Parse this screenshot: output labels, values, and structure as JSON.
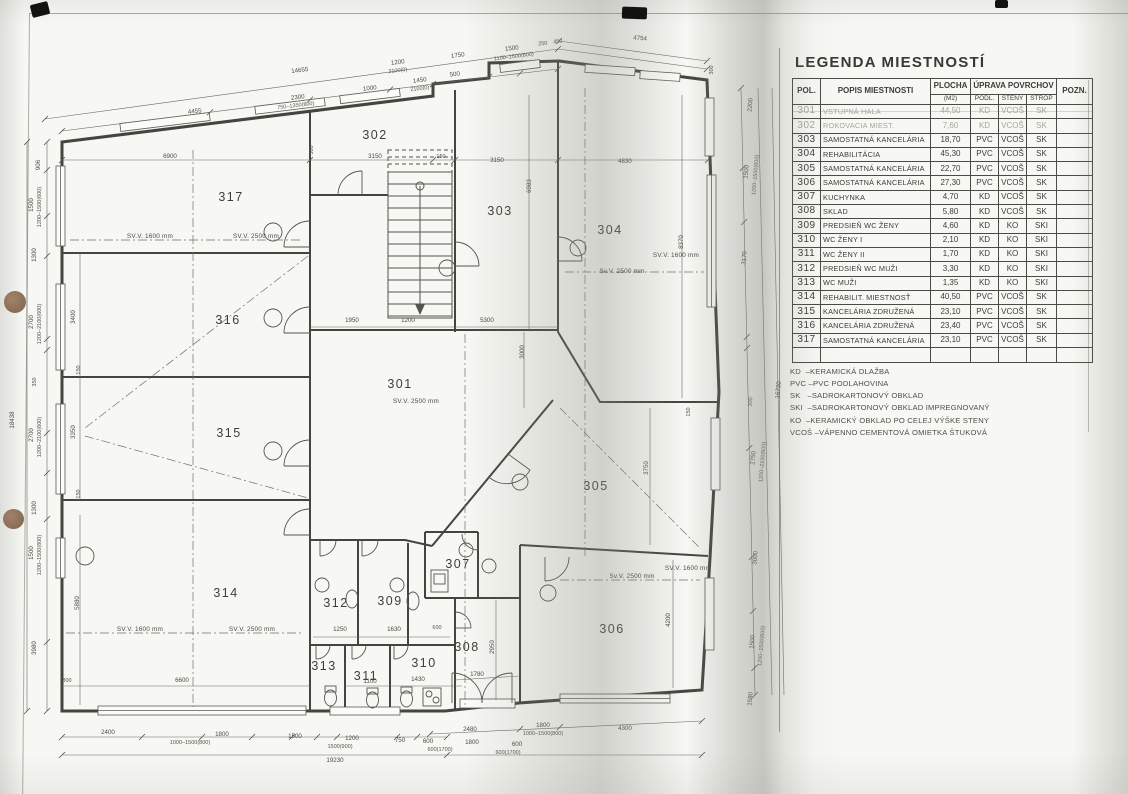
{
  "legend": {
    "title": "LEGENDA MIESTNOSTÍ",
    "header": {
      "pol": "POL.",
      "popis": "POPIS MIESTNOSTI",
      "plocha": "PLOCHA",
      "plocha_unit": "(M2)",
      "uprava": "ÚPRAVA POVRCHOV",
      "podl": "PODL.",
      "steny": "STENY",
      "strop": "STROP",
      "pozn": "POZN."
    },
    "rows": [
      {
        "pol": "301",
        "popis": "VSTUPNÁ HALA",
        "plocha": "44,50",
        "podl": "KD",
        "steny": "VCOŠ",
        "strop": "SK",
        "pozn": "",
        "faded": true
      },
      {
        "pol": "302",
        "popis": "ROKOVACIA MIEST.",
        "plocha": "7,60",
        "podl": "KD",
        "steny": "VCOŠ",
        "strop": "SK",
        "pozn": "",
        "faded": true
      },
      {
        "pol": "303",
        "popis": "SAMOSTATNÁ KANCELÁRIA",
        "plocha": "18,70",
        "podl": "PVC",
        "steny": "VCOŠ",
        "strop": "SK",
        "pozn": ""
      },
      {
        "pol": "304",
        "popis": "REHABILITÁCIA",
        "plocha": "45,30",
        "podl": "PVC",
        "steny": "VCOŠ",
        "strop": "SK",
        "pozn": ""
      },
      {
        "pol": "305",
        "popis": "SAMOSTATNÁ KANCELÁRIA",
        "plocha": "22,70",
        "podl": "PVC",
        "steny": "VCOŠ",
        "strop": "SK",
        "pozn": ""
      },
      {
        "pol": "306",
        "popis": "SAMOSTATNÁ KANCELÁRIA",
        "plocha": "27,30",
        "podl": "PVC",
        "steny": "VCOŠ",
        "strop": "SK",
        "pozn": ""
      },
      {
        "pol": "307",
        "popis": "KUCHYNKA",
        "plocha": "4,70",
        "podl": "KD",
        "steny": "VCOŠ",
        "strop": "SK",
        "pozn": ""
      },
      {
        "pol": "308",
        "popis": "SKLAD",
        "plocha": "5,80",
        "podl": "KD",
        "steny": "VCOŠ",
        "strop": "SK",
        "pozn": ""
      },
      {
        "pol": "309",
        "popis": "PREDSIEŇ WC ŽENY",
        "plocha": "4,60",
        "podl": "KD",
        "steny": "KO",
        "strop": "SKI",
        "pozn": ""
      },
      {
        "pol": "310",
        "popis": "WC ŽENY I",
        "plocha": "2,10",
        "podl": "KD",
        "steny": "KO",
        "strop": "SKI",
        "pozn": ""
      },
      {
        "pol": "311",
        "popis": "WC ŽENY II",
        "plocha": "1,70",
        "podl": "KD",
        "steny": "KO",
        "strop": "SKI",
        "pozn": ""
      },
      {
        "pol": "312",
        "popis": "PREDSIEŇ WC MUŽI",
        "plocha": "3,30",
        "podl": "KD",
        "steny": "KO",
        "strop": "SKI",
        "pozn": ""
      },
      {
        "pol": "313",
        "popis": "WC MUŽI",
        "plocha": "1,35",
        "podl": "KD",
        "steny": "KO",
        "strop": "SKI",
        "pozn": ""
      },
      {
        "pol": "314",
        "popis": "REHABILIT. MIESTNOSŤ",
        "plocha": "40,50",
        "podl": "PVC",
        "steny": "VCOŠ",
        "strop": "SK",
        "pozn": ""
      },
      {
        "pol": "315",
        "popis": "KANCELÁRIA ZDRUŽENÁ",
        "plocha": "23,10",
        "podl": "PVC",
        "steny": "VCOŠ",
        "strop": "SK",
        "pozn": ""
      },
      {
        "pol": "316",
        "popis": "KANCELÁRIA ZDRUŽENÁ",
        "plocha": "23,40",
        "podl": "PVC",
        "steny": "VCOŠ",
        "strop": "SK",
        "pozn": ""
      },
      {
        "pol": "317",
        "popis": "SAMOSTATNÁ KANCELÁRIA",
        "plocha": "23,10",
        "podl": "PVC",
        "steny": "VCOŠ",
        "strop": "SK",
        "pozn": ""
      }
    ],
    "notes": [
      "KD  –KERAMICKÁ DLAŽBA",
      "PVC –PVC PODLAHOVINA",
      "SK   –SADROKARTONOVÝ OBKLAD",
      "SKI  –SADROKARTONOVÝ OBKLAD IMPREGNOVANÝ",
      "KO  –KERAMICKÝ OBKLAD PO CELEJ VÝŠKE STENY",
      "VCOŠ –VÁPENNO CEMENTOVÁ OMIETKA ŠTUKOVÁ"
    ]
  },
  "plan": {
    "rooms": [
      {
        "n": "301",
        "x": 400,
        "y": 388
      },
      {
        "n": "302",
        "x": 375,
        "y": 139
      },
      {
        "n": "303",
        "x": 500,
        "y": 215
      },
      {
        "n": "304",
        "x": 610,
        "y": 234
      },
      {
        "n": "305",
        "x": 596,
        "y": 490
      },
      {
        "n": "306",
        "x": 612,
        "y": 633
      },
      {
        "n": "307",
        "x": 458,
        "y": 568
      },
      {
        "n": "308",
        "x": 467,
        "y": 651
      },
      {
        "n": "309",
        "x": 390,
        "y": 605
      },
      {
        "n": "310",
        "x": 424,
        "y": 667
      },
      {
        "n": "311",
        "x": 366,
        "y": 680
      },
      {
        "n": "312",
        "x": 336,
        "y": 607
      },
      {
        "n": "313",
        "x": 324,
        "y": 670
      },
      {
        "n": "314",
        "x": 226,
        "y": 597
      },
      {
        "n": "315",
        "x": 229,
        "y": 437
      },
      {
        "n": "316",
        "x": 228,
        "y": 324
      },
      {
        "n": "317",
        "x": 231,
        "y": 201
      }
    ],
    "svv_labels": [
      {
        "t": "SV.V. 1600 mm",
        "x": 150,
        "y": 238
      },
      {
        "t": "SV.V. 2500 mm",
        "x": 256,
        "y": 238
      },
      {
        "t": "SV.V. 1600 mm",
        "x": 676,
        "y": 257
      },
      {
        "t": "Sv.V. 2500 mm",
        "x": 622,
        "y": 273
      },
      {
        "t": "SV.V. 2500 mm",
        "x": 416,
        "y": 403
      },
      {
        "t": "SV.V. 1600 mm",
        "x": 140,
        "y": 631
      },
      {
        "t": "SV.V. 2500 mm",
        "x": 252,
        "y": 631
      },
      {
        "t": "Sv.V. 2500 mm",
        "x": 632,
        "y": 578
      },
      {
        "t": "SV.V. 1600 mm",
        "x": 688,
        "y": 570
      }
    ],
    "dims": [
      {
        "t": "4455",
        "x": 195,
        "y": 113,
        "r": -7
      },
      {
        "t": "2300",
        "x": 298,
        "y": 99,
        "r": -7
      },
      {
        "t": "750–1350(800)",
        "x": 296,
        "y": 107,
        "r": -7,
        "s": 1
      },
      {
        "t": "1000",
        "x": 370,
        "y": 90,
        "r": -7
      },
      {
        "t": "1450",
        "x": 420,
        "y": 82,
        "r": -7
      },
      {
        "t": "2100(0)",
        "x": 420,
        "y": 90,
        "r": -7,
        "s": 1
      },
      {
        "t": "500",
        "x": 455,
        "y": 76,
        "r": -7
      },
      {
        "t": "14655",
        "x": 300,
        "y": 72,
        "r": -7
      },
      {
        "t": "1200",
        "x": 398,
        "y": 64,
        "r": -7
      },
      {
        "t": "2100(0)",
        "x": 398,
        "y": 72,
        "r": -7,
        "s": 1
      },
      {
        "t": "1750",
        "x": 458,
        "y": 57,
        "r": -7
      },
      {
        "t": "1500",
        "x": 512,
        "y": 50,
        "r": -7
      },
      {
        "t": "1100–1500(800)",
        "x": 514,
        "y": 58,
        "r": -7,
        "s": 1
      },
      {
        "t": "250",
        "x": 543,
        "y": 45,
        "r": -7,
        "s": 1
      },
      {
        "t": "450",
        "x": 558,
        "y": 43,
        "r": -7,
        "s": 1
      },
      {
        "t": "4754",
        "x": 640,
        "y": 40,
        "r": 4
      },
      {
        "t": "300",
        "x": 713,
        "y": 70,
        "r": -90,
        "s": 1
      },
      {
        "t": "18438",
        "x": 14,
        "y": 420,
        "r": -90
      },
      {
        "t": "906",
        "x": 40,
        "y": 165,
        "r": -90
      },
      {
        "t": "1500",
        "x": 33,
        "y": 205,
        "r": -90
      },
      {
        "t": "1200–1500(600)",
        "x": 41,
        "y": 207,
        "r": -90,
        "s": 1
      },
      {
        "t": "1300",
        "x": 36,
        "y": 255,
        "r": -90
      },
      {
        "t": "2700",
        "x": 33,
        "y": 322,
        "r": -90
      },
      {
        "t": "1200–2100(600)",
        "x": 41,
        "y": 324,
        "r": -90,
        "s": 1
      },
      {
        "t": "350",
        "x": 36,
        "y": 382,
        "r": -90,
        "s": 1
      },
      {
        "t": "2700",
        "x": 33,
        "y": 435,
        "r": -90
      },
      {
        "t": "1200–2100(600)",
        "x": 41,
        "y": 437,
        "r": -90,
        "s": 1
      },
      {
        "t": "1300",
        "x": 36,
        "y": 508,
        "r": -90
      },
      {
        "t": "1500",
        "x": 33,
        "y": 553,
        "r": -90
      },
      {
        "t": "1200–1500(800)",
        "x": 41,
        "y": 555,
        "r": -90,
        "s": 1
      },
      {
        "t": "3980",
        "x": 36,
        "y": 648,
        "r": -90
      },
      {
        "t": "2400",
        "x": 108,
        "y": 734
      },
      {
        "t": "1800",
        "x": 222,
        "y": 736
      },
      {
        "t": "1000–1500(800)",
        "x": 190,
        "y": 744,
        "s": 1
      },
      {
        "t": "1500",
        "x": 295,
        "y": 738
      },
      {
        "t": "1200",
        "x": 352,
        "y": 740
      },
      {
        "t": "1500(900)",
        "x": 340,
        "y": 748,
        "s": 1
      },
      {
        "t": "750",
        "x": 400,
        "y": 742
      },
      {
        "t": "600",
        "x": 428,
        "y": 743
      },
      {
        "t": "600(1700)",
        "x": 440,
        "y": 751,
        "s": 1
      },
      {
        "t": "1800",
        "x": 472,
        "y": 744
      },
      {
        "t": "600",
        "x": 517,
        "y": 746
      },
      {
        "t": "600(1700)",
        "x": 508,
        "y": 754,
        "s": 1
      },
      {
        "t": "19230",
        "x": 335,
        "y": 762
      },
      {
        "t": "2480",
        "x": 470,
        "y": 731
      },
      {
        "t": "1800",
        "x": 543,
        "y": 727
      },
      {
        "t": "1000–1500(800)",
        "x": 543,
        "y": 735,
        "s": 1
      },
      {
        "t": "4300",
        "x": 625,
        "y": 730
      },
      {
        "t": "16720",
        "x": 780,
        "y": 390,
        "r": -85
      },
      {
        "t": "2200",
        "x": 752,
        "y": 105,
        "r": -85
      },
      {
        "t": "1500",
        "x": 748,
        "y": 172,
        "r": -85
      },
      {
        "t": "1200–1500(600)",
        "x": 757,
        "y": 175,
        "r": -85,
        "s": 1
      },
      {
        "t": "3170",
        "x": 746,
        "y": 258,
        "r": -85
      },
      {
        "t": "300",
        "x": 752,
        "y": 402,
        "r": -85,
        "s": 1
      },
      {
        "t": "2750",
        "x": 755,
        "y": 458,
        "r": -85
      },
      {
        "t": "1200–2100(600)",
        "x": 764,
        "y": 462,
        "r": -85,
        "s": 1
      },
      {
        "t": "3000",
        "x": 757,
        "y": 558,
        "r": -85
      },
      {
        "t": "1500",
        "x": 754,
        "y": 642,
        "r": -85
      },
      {
        "t": "1200–1500(600)",
        "x": 763,
        "y": 646,
        "r": -85,
        "s": 1
      },
      {
        "t": "1580",
        "x": 752,
        "y": 699,
        "r": -85
      },
      {
        "t": "6900",
        "x": 170,
        "y": 158
      },
      {
        "t": "300",
        "x": 313,
        "y": 150,
        "r": -90,
        "s": 1
      },
      {
        "t": "3150",
        "x": 375,
        "y": 158
      },
      {
        "t": "150",
        "x": 441,
        "y": 158,
        "s": 1
      },
      {
        "t": "3150",
        "x": 497,
        "y": 162
      },
      {
        "t": "4830",
        "x": 625,
        "y": 163
      },
      {
        "t": "6983",
        "x": 531,
        "y": 186,
        "r": -90
      },
      {
        "t": "8370",
        "x": 683,
        "y": 242,
        "r": -90
      },
      {
        "t": "1950",
        "x": 352,
        "y": 322
      },
      {
        "t": "1200",
        "x": 408,
        "y": 322
      },
      {
        "t": "5300",
        "x": 487,
        "y": 322
      },
      {
        "t": "3000",
        "x": 524,
        "y": 352,
        "r": -90
      },
      {
        "t": "3400",
        "x": 75,
        "y": 317,
        "r": -90
      },
      {
        "t": "150",
        "x": 80,
        "y": 370,
        "r": -90,
        "s": 1
      },
      {
        "t": "3350",
        "x": 75,
        "y": 432,
        "r": -90
      },
      {
        "t": "150",
        "x": 80,
        "y": 494,
        "r": -90,
        "s": 1
      },
      {
        "t": "5880",
        "x": 79,
        "y": 603,
        "r": -90
      },
      {
        "t": "300",
        "x": 67,
        "y": 682,
        "s": 1
      },
      {
        "t": "6600",
        "x": 182,
        "y": 682
      },
      {
        "t": "1250",
        "x": 340,
        "y": 631
      },
      {
        "t": "1630",
        "x": 394,
        "y": 631
      },
      {
        "t": "600",
        "x": 437,
        "y": 629,
        "s": 1
      },
      {
        "t": "1100",
        "x": 370,
        "y": 683
      },
      {
        "t": "1430",
        "x": 418,
        "y": 681
      },
      {
        "t": "1780",
        "x": 477,
        "y": 676
      },
      {
        "t": "2950",
        "x": 494,
        "y": 647,
        "r": -90
      },
      {
        "t": "3750",
        "x": 648,
        "y": 468,
        "r": -90
      },
      {
        "t": "150",
        "x": 690,
        "y": 412,
        "r": -90,
        "s": 1
      },
      {
        "t": "4200",
        "x": 670,
        "y": 620,
        "r": -90
      }
    ]
  }
}
